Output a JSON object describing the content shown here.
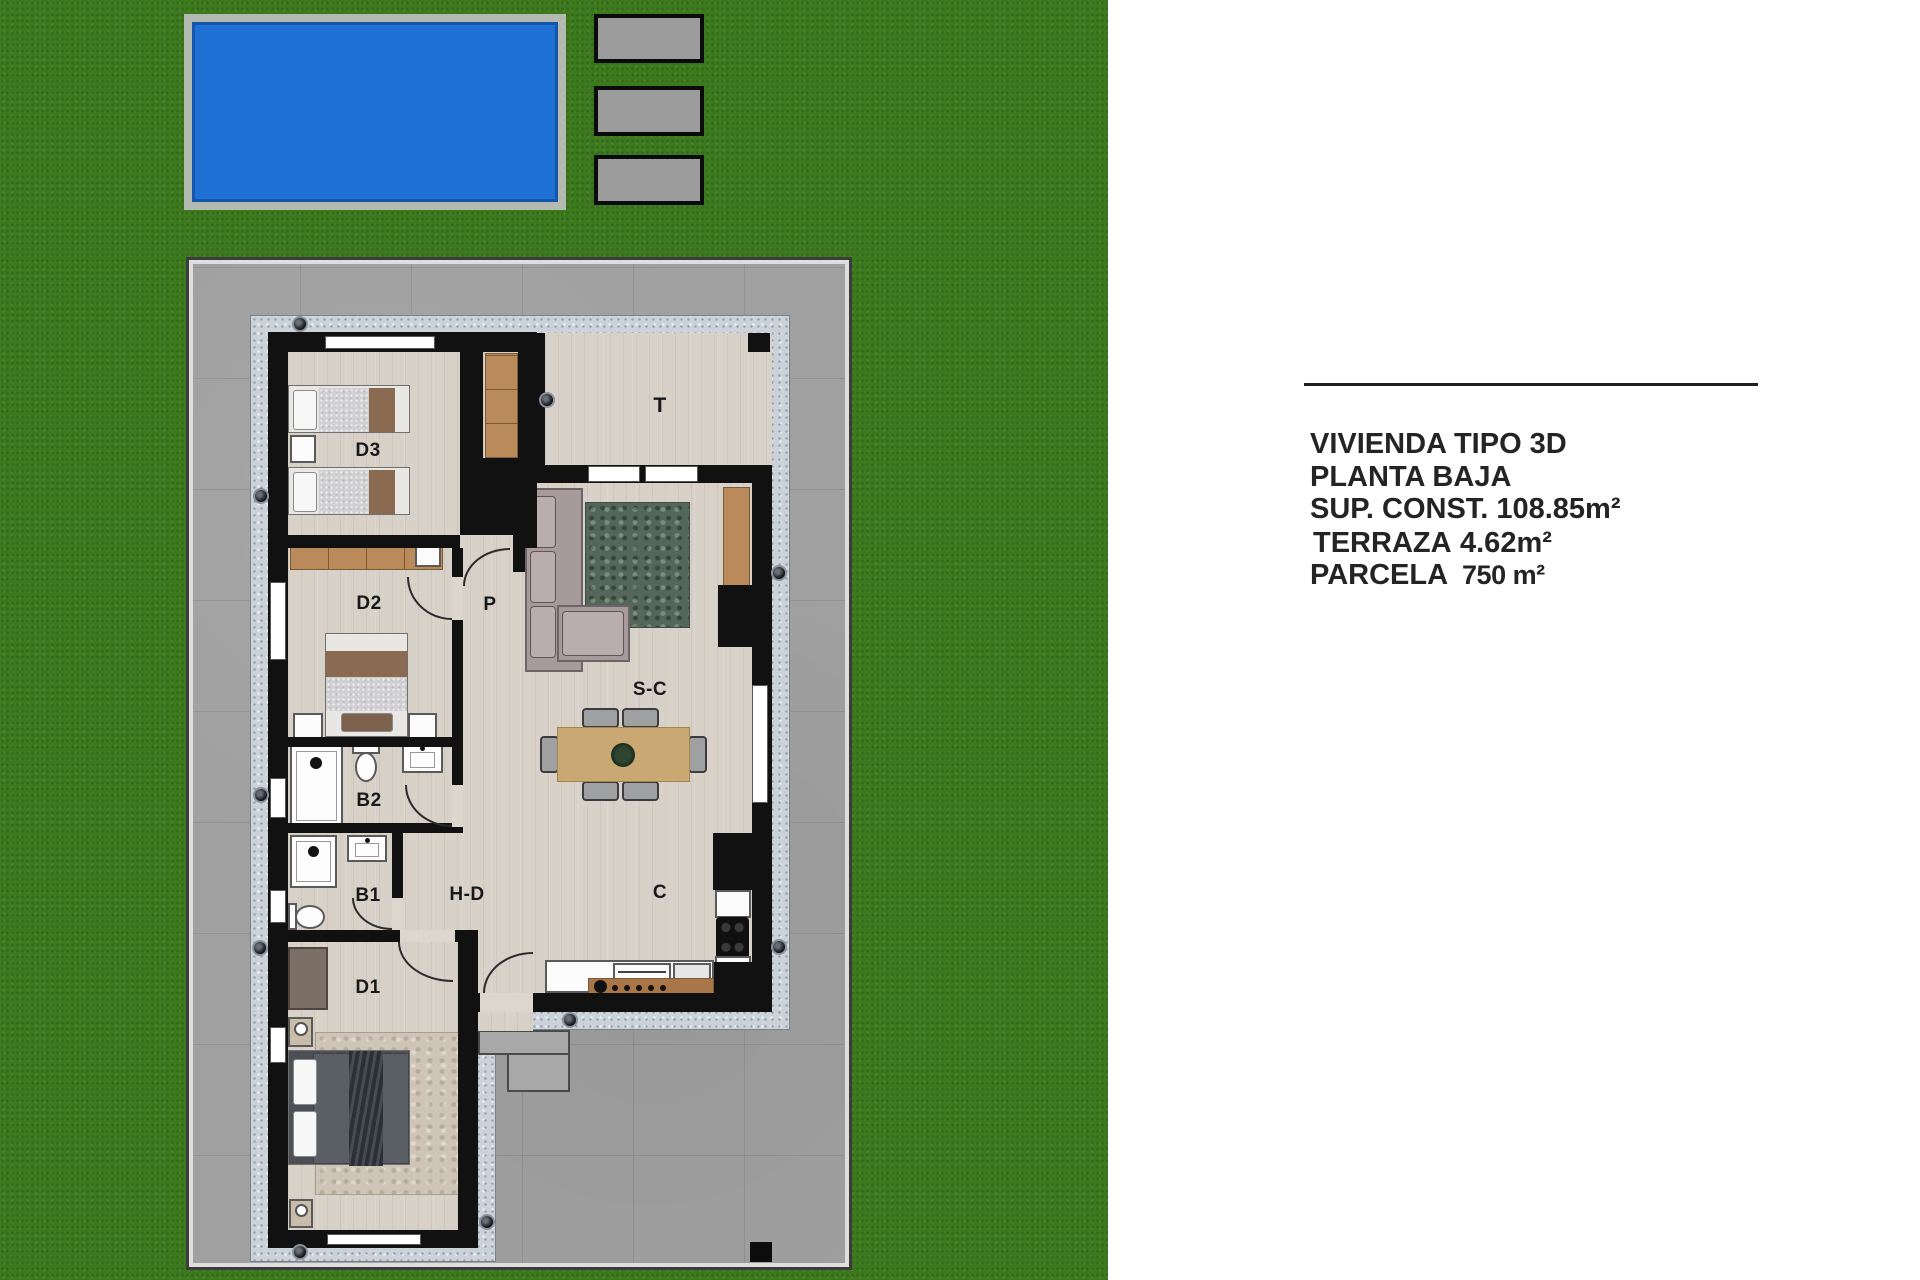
{
  "panel": {
    "line1": "VIVIENDA TIPO 3D",
    "line2": "PLANTA BAJA",
    "specs": [
      {
        "label": "SUP. CONST.",
        "value": "108.85m²"
      },
      {
        "label": "TERRAZA",
        "value": "4.62m²"
      },
      {
        "label": "PARCELA",
        "value": "750 m²"
      }
    ]
  },
  "rooms": [
    {
      "label": "D3"
    },
    {
      "label": "D2"
    },
    {
      "label": "P"
    },
    {
      "label": "T"
    },
    {
      "label": "S-C"
    },
    {
      "label": "B2"
    },
    {
      "label": "B1"
    },
    {
      "label": "H-D"
    },
    {
      "label": "C"
    },
    {
      "label": "D1"
    }
  ],
  "colors": {
    "grass": "#3d7a1e",
    "pool_water": "#1f70d4",
    "pool_frame": "#b4bab0",
    "concrete": "#a0a0a0",
    "walkway": "#cbd2d9",
    "wall": "#111111",
    "floor": "#d8d1c8",
    "furniture_wood": "#bb8a5a",
    "rug_green": "#55675a",
    "sofa": "#a79a9c",
    "text": "#242424"
  }
}
